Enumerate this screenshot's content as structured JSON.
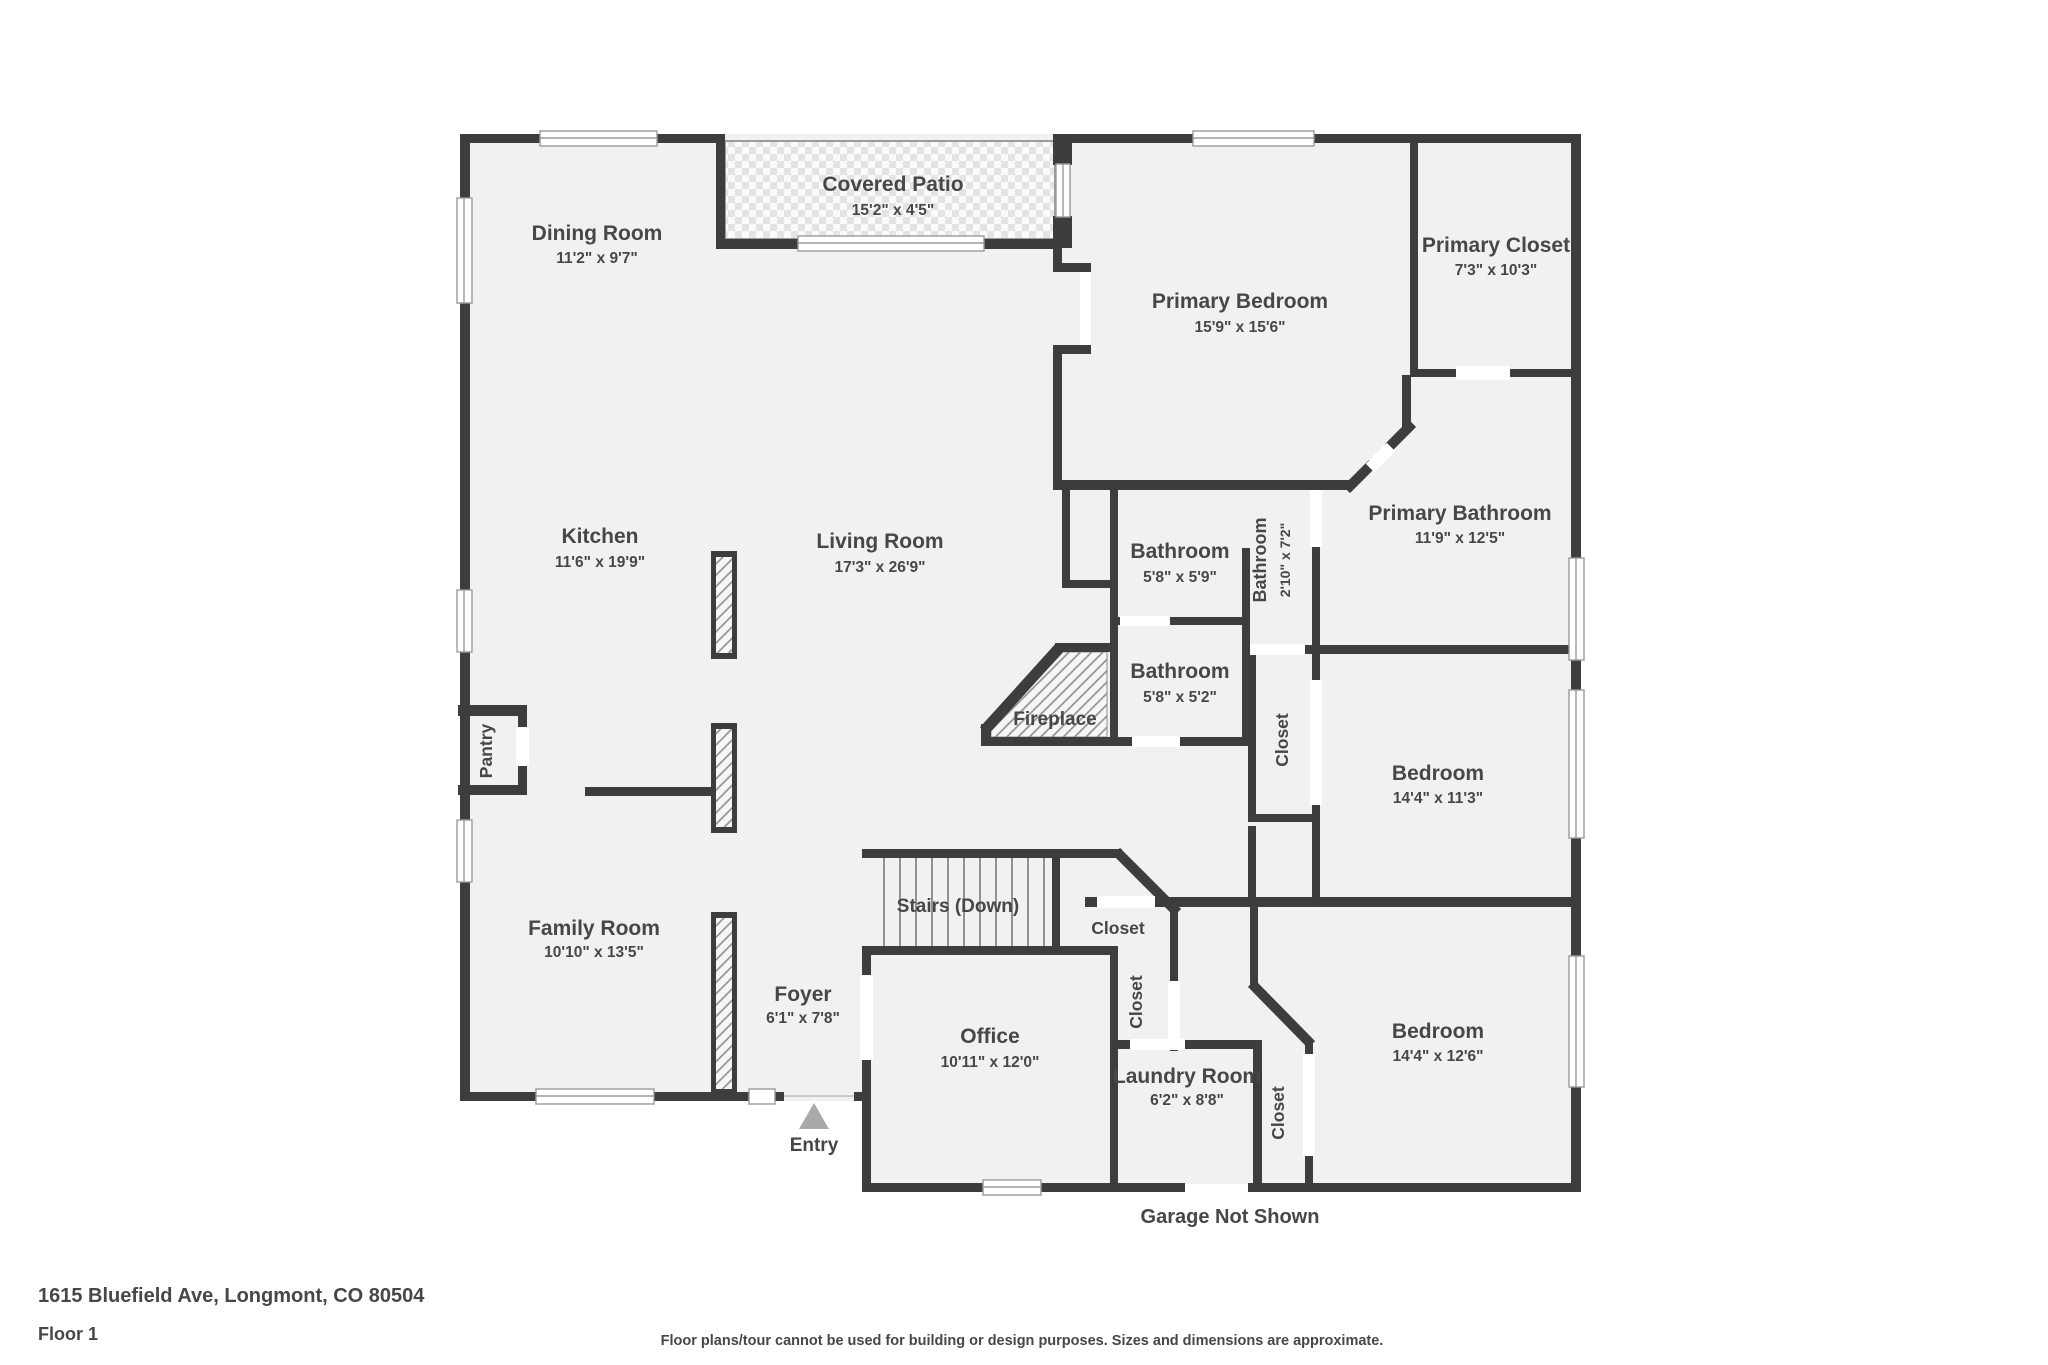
{
  "colors": {
    "wall": "#3d3d3d",
    "floor": "#f1f1f2",
    "patio_tile": "#e4e4e4",
    "hatch_line": "#8d8d8d",
    "window_line": "#999999",
    "entry_marker": "#a9a9a9",
    "text": "#474747"
  },
  "rooms": {
    "covered_patio": {
      "name": "Covered Patio",
      "dims": "15'2\" x 4'5\""
    },
    "dining_room": {
      "name": "Dining Room",
      "dims": "11'2\" x 9'7\""
    },
    "primary_bedroom": {
      "name": "Primary Bedroom",
      "dims": "15'9\" x 15'6\""
    },
    "primary_closet": {
      "name": "Primary Closet",
      "dims": "7'3\" x 10'3\""
    },
    "kitchen": {
      "name": "Kitchen",
      "dims": "11'6\" x 19'9\""
    },
    "living_room": {
      "name": "Living Room",
      "dims": "17'3\" x 26'9\""
    },
    "bathroom_top": {
      "name": "Bathroom",
      "dims": "5'8\" x 5'9\""
    },
    "bathroom_small": {
      "name": "Bathroom",
      "dims": "2'10\" x 7'2\""
    },
    "primary_bathroom": {
      "name": "Primary Bathroom",
      "dims": "11'9\" x 12'5\""
    },
    "bathroom_mid": {
      "name": "Bathroom",
      "dims": "5'8\" x 5'2\""
    },
    "bedroom_1": {
      "name": "Bedroom",
      "dims": "14'4\" x 11'3\""
    },
    "bedroom_2": {
      "name": "Bedroom",
      "dims": "14'4\" x 12'6\""
    },
    "family_room": {
      "name": "Family Room",
      "dims": "10'10\" x 13'5\""
    },
    "foyer": {
      "name": "Foyer",
      "dims": "6'1\" x 7'8\""
    },
    "office": {
      "name": "Office",
      "dims": "10'11\" x 12'0\""
    },
    "laundry_room": {
      "name": "Laundry Room",
      "dims": "6'2\" x 8'8\""
    }
  },
  "labels": {
    "fireplace": "Fireplace",
    "pantry": "Pantry",
    "stairs": "Stairs (Down)",
    "closet_stairs": "Closet",
    "closet_hall": "Closet",
    "closet_bedroom1": "Closet",
    "closet_bedroom2": "Closet",
    "entry": "Entry",
    "garage_note": "Garage Not Shown"
  },
  "footer": {
    "address": "1615 Bluefield Ave, Longmont, CO 80504",
    "floor": "Floor 1",
    "disclaimer": "Floor plans/tour cannot be used for building or design purposes. Sizes and dimensions are approximate."
  }
}
